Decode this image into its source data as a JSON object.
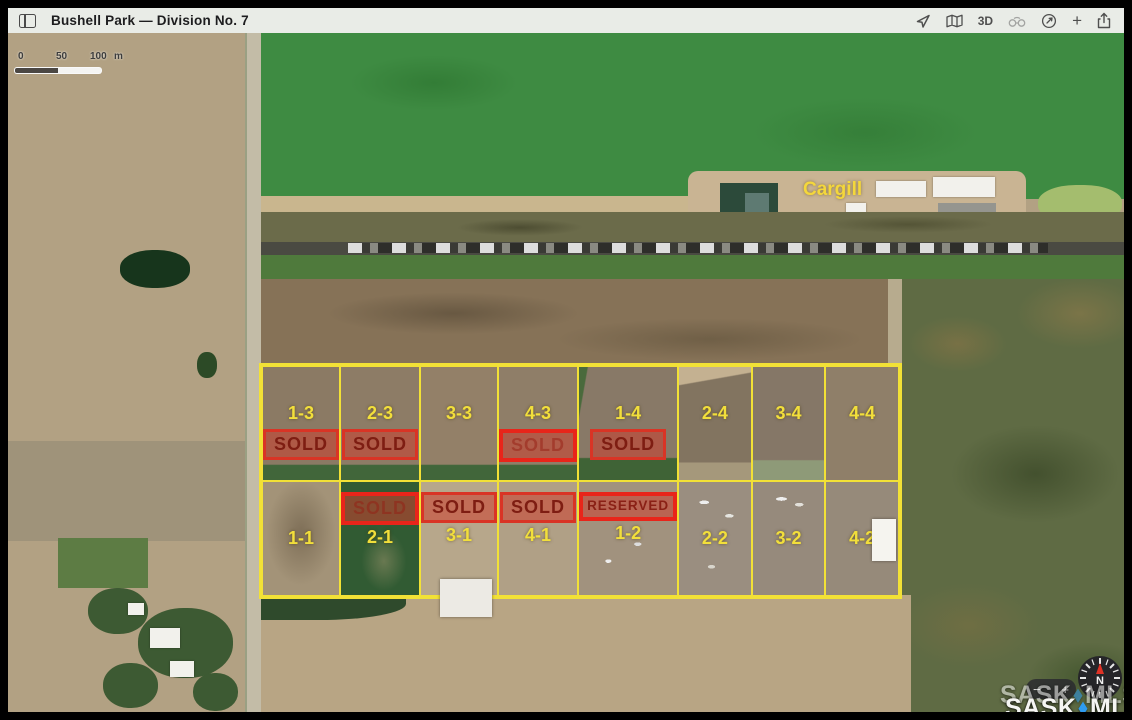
{
  "titlebar": {
    "title": "Bushell Park — Division No. 7",
    "threed_label": "3D"
  },
  "toolbar_icons": [
    "sidebar-toggle",
    "location-arrow",
    "map",
    "3d",
    "binoculars",
    "compass-dial",
    "plus",
    "share"
  ],
  "scalebar": {
    "t0": "0",
    "t50": "50",
    "t100": "100",
    "unit": "m"
  },
  "map_labels": {
    "cargill": "Cargill"
  },
  "lots": {
    "row_top": [
      {
        "label": "1-3",
        "status": "SOLD"
      },
      {
        "label": "2-3",
        "status": "SOLD"
      },
      {
        "label": "3-3"
      },
      {
        "label": "4-3",
        "status": "SOLD"
      },
      {
        "label": "1-4",
        "status": "SOLD"
      },
      {
        "label": "2-4"
      },
      {
        "label": "3-4"
      },
      {
        "label": "4-4"
      }
    ],
    "row_bottom": [
      {
        "label": "1-1"
      },
      {
        "label": "2-1",
        "status": "SOLD"
      },
      {
        "label": "3-1",
        "status": "SOLD"
      },
      {
        "label": "4-1",
        "status": "SOLD"
      },
      {
        "label": "1-2",
        "status": "RESERVED"
      },
      {
        "label": "2-2"
      },
      {
        "label": "3-2"
      },
      {
        "label": "4-2"
      }
    ]
  },
  "zoom_controls": {
    "minus": "−",
    "plus": "+"
  },
  "compass": {
    "north": "N"
  },
  "watermark": {
    "sask": "SASK",
    "mls": "MLS",
    "reg": "®"
  },
  "colors": {
    "lot_line_yellow": "#F2E136",
    "badge_red": "#E0301F",
    "field_green": "#3E8B42",
    "watermark_blue": "#2E9BF0"
  }
}
